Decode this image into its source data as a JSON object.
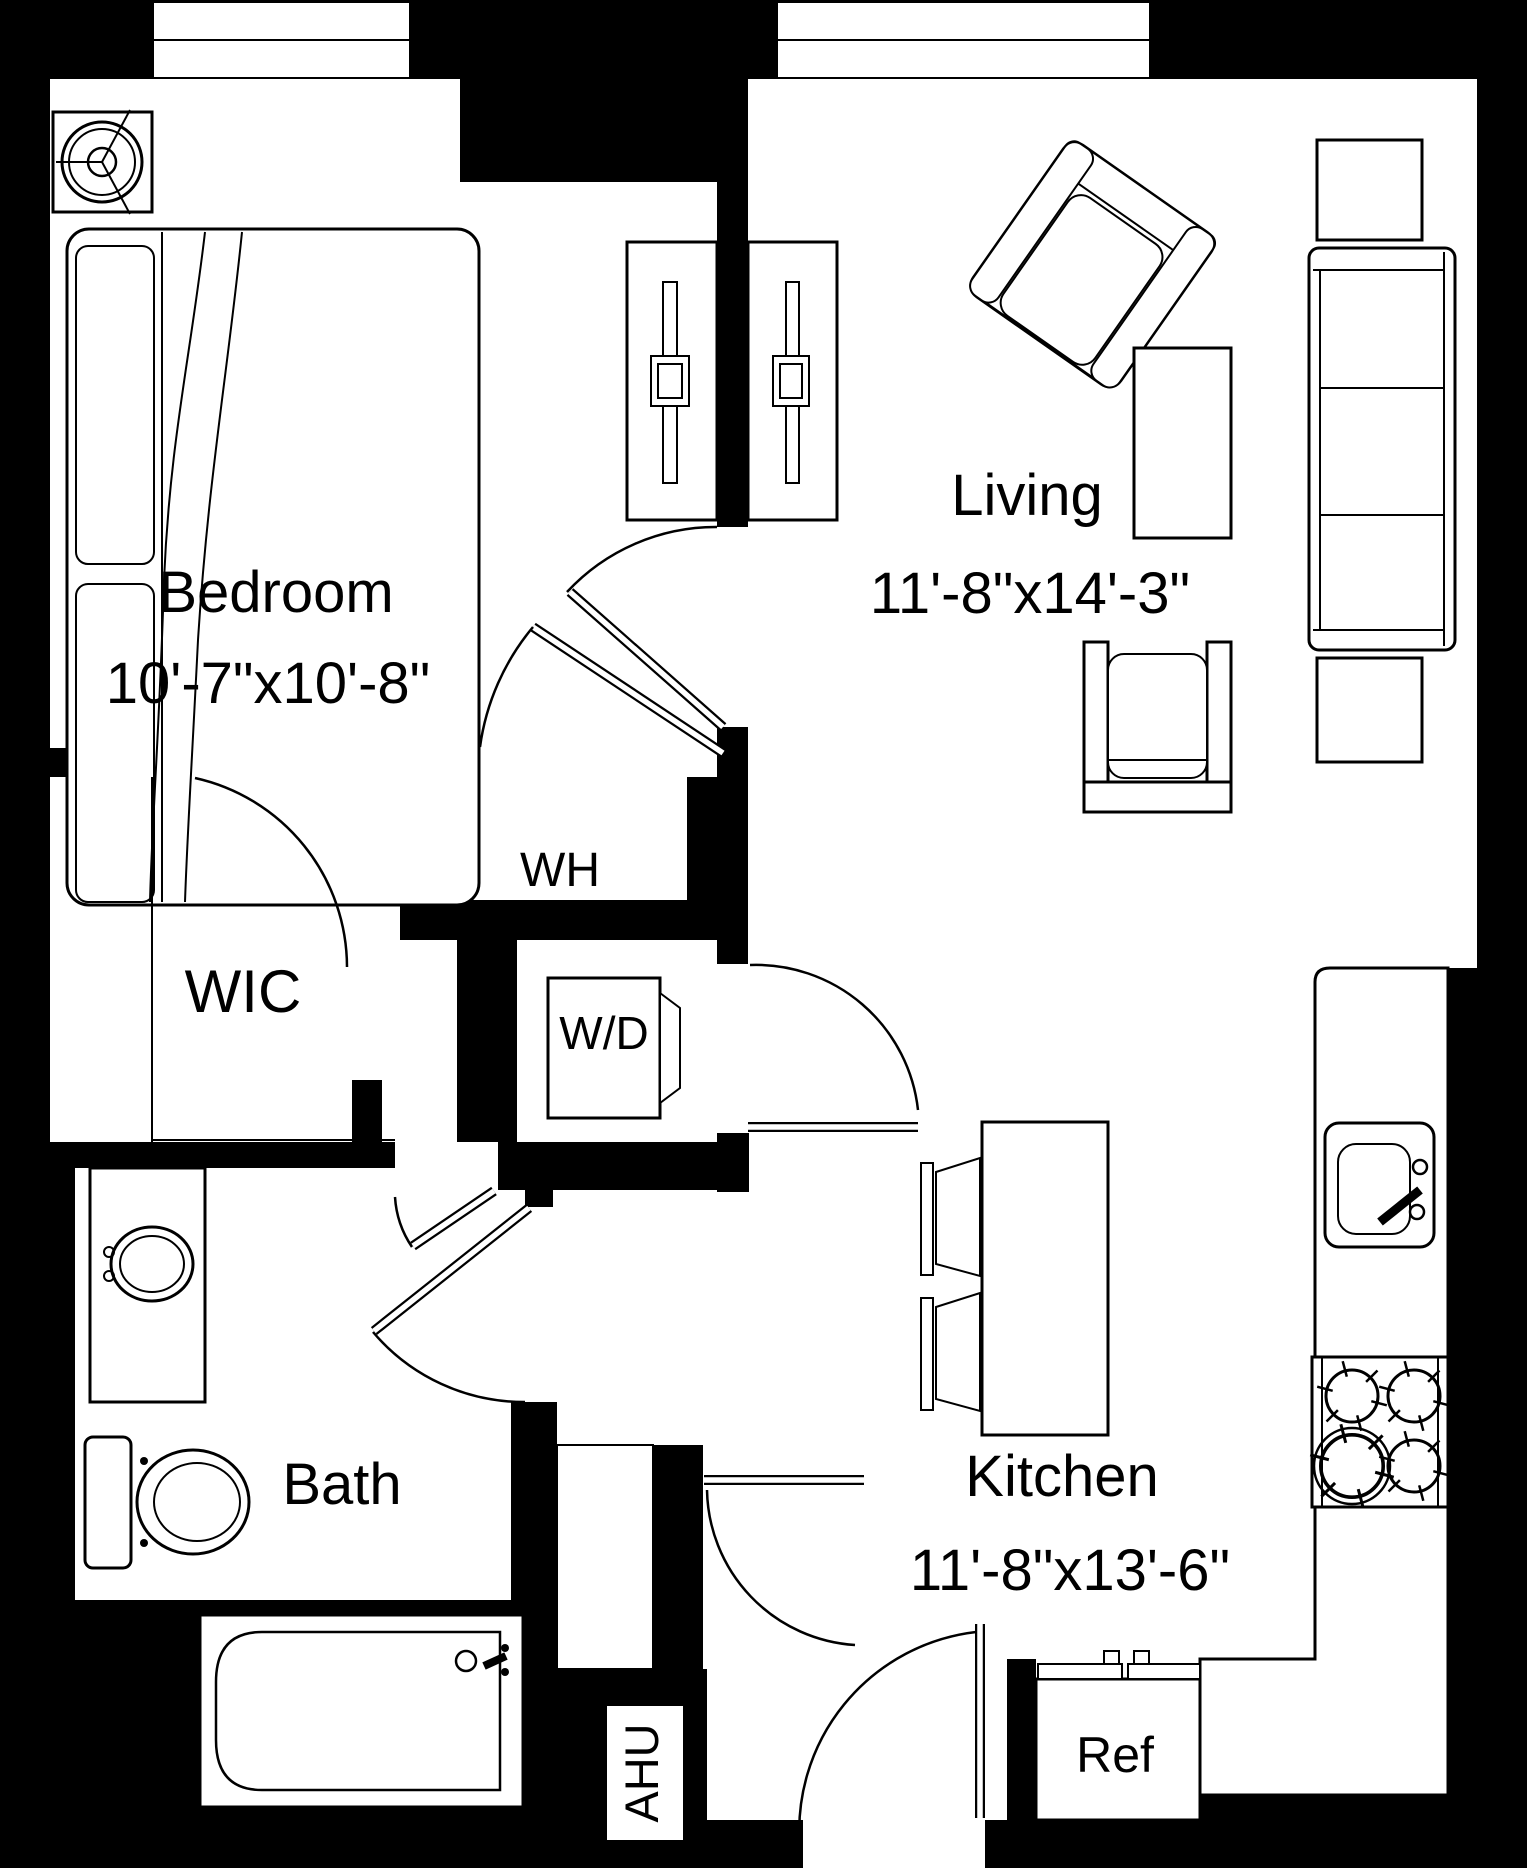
{
  "plan": {
    "type": "apartment-floor-plan",
    "colors": {
      "wall": "#000000",
      "floor": "#ffffff",
      "line": "#000000"
    },
    "rooms": {
      "bedroom": {
        "name": "Bedroom",
        "dims": "10'-7\"x10'-8\""
      },
      "living": {
        "name": "Living",
        "dims": "11'-8\"x14'-3\""
      },
      "kitchen": {
        "name": "Kitchen",
        "dims": "11'-8\"x13'-6\""
      },
      "bath": {
        "name": "Bath"
      },
      "wic": {
        "name": "WIC"
      },
      "water_heater": {
        "name": "WH"
      },
      "washer_dryer": {
        "name": "W/D"
      },
      "air_handler": {
        "name": "AHU"
      },
      "refrigerator": {
        "name": "Ref"
      }
    }
  }
}
